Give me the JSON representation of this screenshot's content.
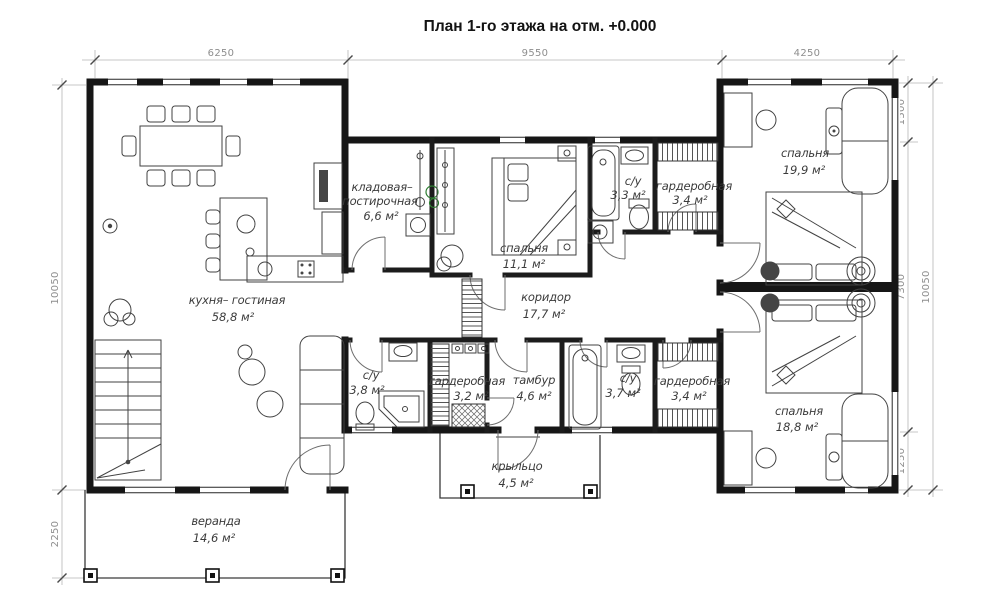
{
  "title": "План 1-го этажа на отм. +0.000",
  "colors": {
    "plant_green": "#2e7d32",
    "wall_black": "#161616",
    "dim_gray": "#8e8e8e"
  },
  "dims": {
    "top": [
      "6250",
      "9550",
      "4250"
    ],
    "left": [
      "10050",
      "2250"
    ],
    "right": [
      "1500",
      "7300",
      "1250",
      "10050"
    ]
  },
  "rooms": {
    "kitchen_living": {
      "name": "кухня– гостиная",
      "area": "58,8 м²"
    },
    "pantry": {
      "name1": "кладовая–",
      "name2": "постирочная",
      "area": "6,6 м²"
    },
    "bedroom_11": {
      "name": "спальня",
      "area": "11,1 м²"
    },
    "wc_33": {
      "name": "с/у",
      "area": "3,3 м²"
    },
    "wardrobe_34_top": {
      "name": "гардеробная",
      "area": "3,4 м²"
    },
    "bedroom_199": {
      "name": "спальня",
      "area": "19,9 м²"
    },
    "corridor": {
      "name": "коридор",
      "area": "17,7 м²"
    },
    "wc_38": {
      "name": "с/у",
      "area": "3,8 м²"
    },
    "wardrobe_32": {
      "name": "гардеробная",
      "area": "3,2 м²"
    },
    "tambour": {
      "name": "тамбур",
      "area": "4,6 м²"
    },
    "wc_37": {
      "name": "с/у",
      "area": "3,7 м²"
    },
    "wardrobe_34_bottom": {
      "name": "гардеробная",
      "area": "3,4 м²"
    },
    "bedroom_188": {
      "name": "спальня",
      "area": "18,8 м²"
    },
    "porch": {
      "name": "крыльцо",
      "area": "4,5 м²"
    },
    "veranda": {
      "name": "веранда",
      "area": "14,6 м²"
    }
  }
}
